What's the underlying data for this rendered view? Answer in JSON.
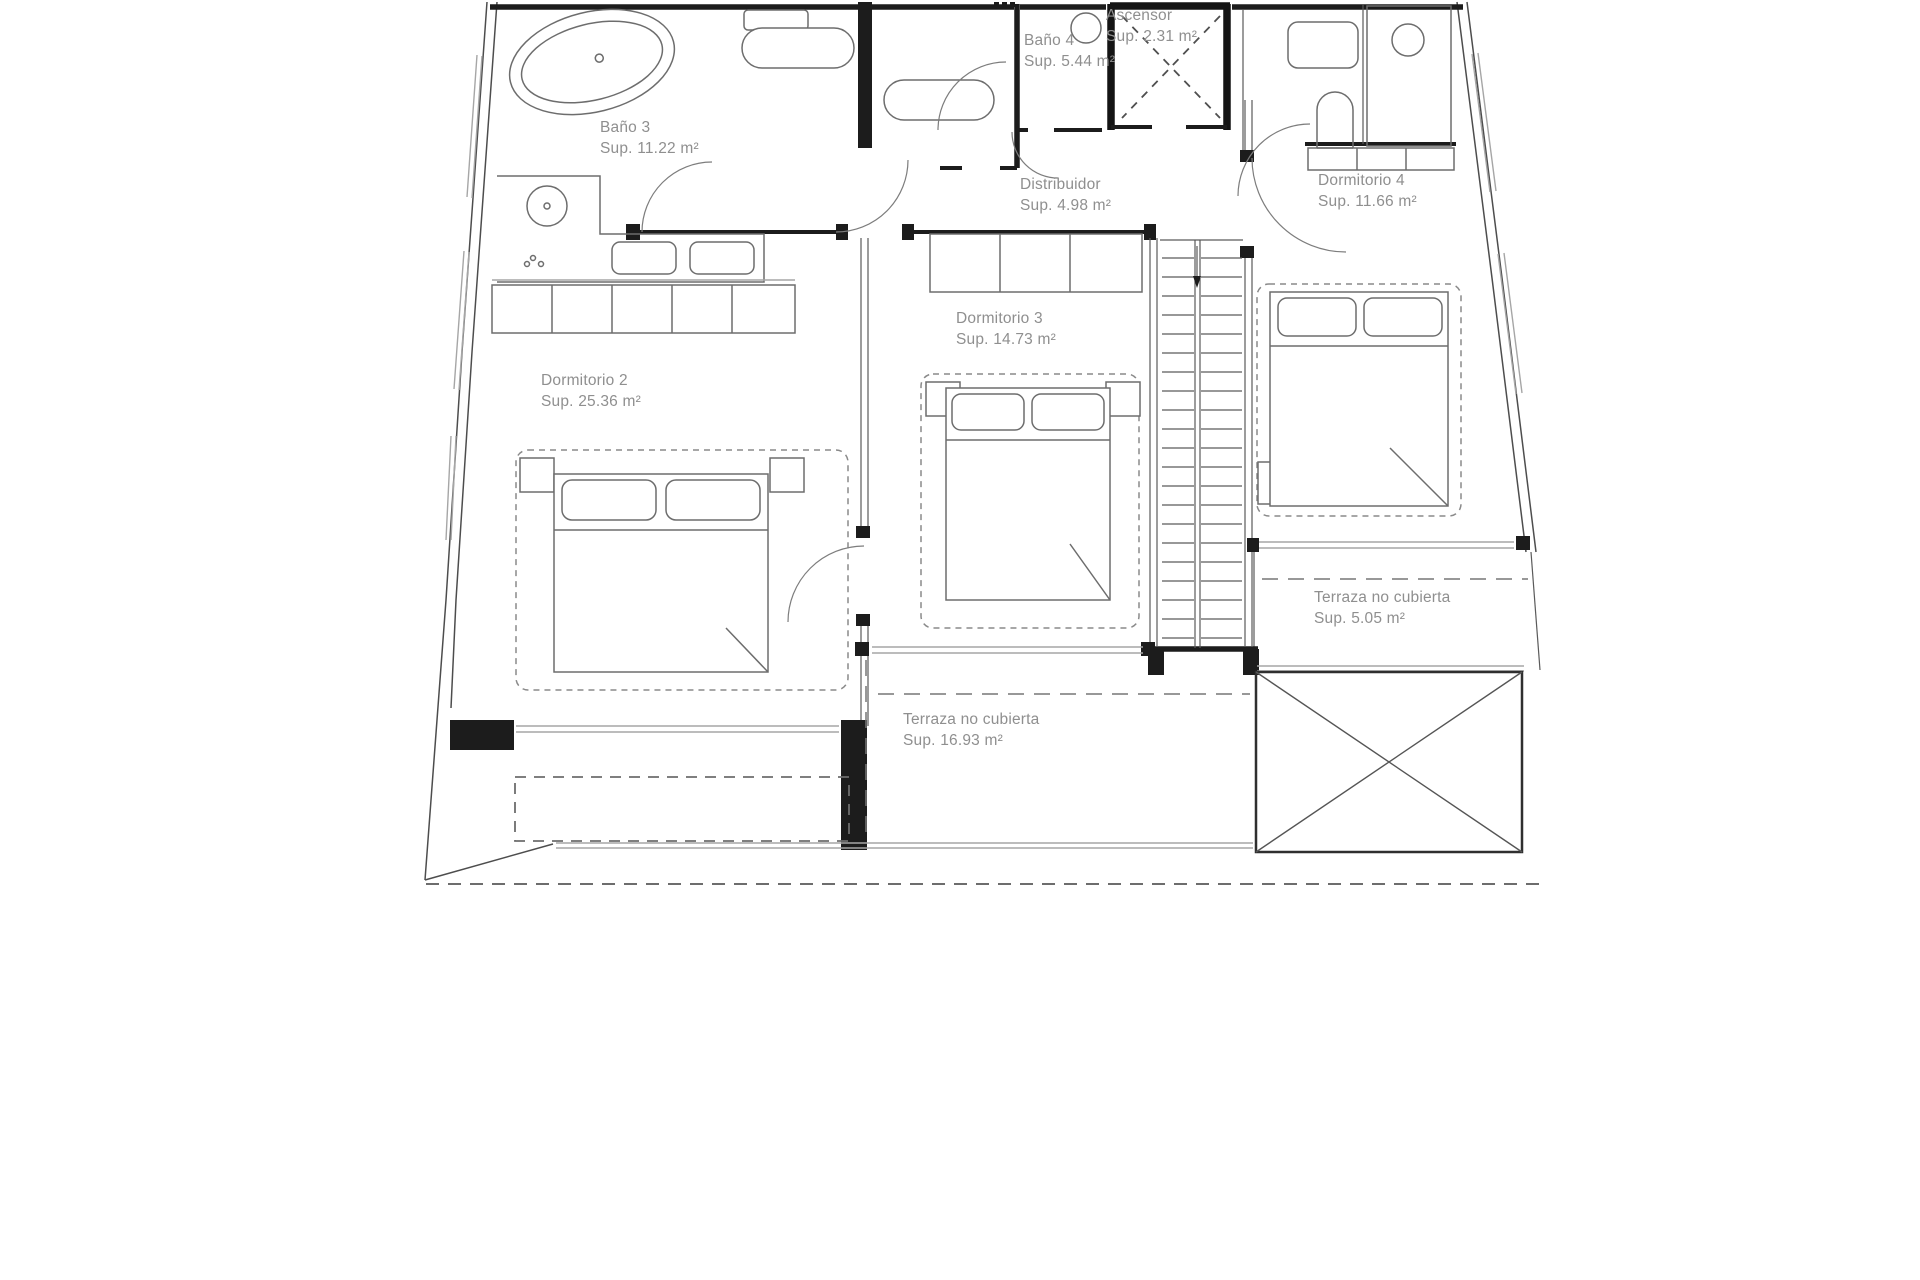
{
  "page": {
    "background": "#ffffff",
    "line_color": "#4d4d4d",
    "label_color": "#8f8f8f"
  },
  "plan": {
    "type": "architectural-floor-plan",
    "language": "Spanish",
    "rooms": [
      {
        "id": "bano3",
        "name": "Baño 3",
        "area": "Sup. 11.22 m²",
        "x": 600,
        "y": 117
      },
      {
        "id": "bano4",
        "name": "Baño 4",
        "area": "Sup. 5.44 m²",
        "x": 1024,
        "y": 30
      },
      {
        "id": "ascensor",
        "name": "Ascensor",
        "area": "Sup. 2.31 m²",
        "x": 1106,
        "y": 5
      },
      {
        "id": "distribuidor",
        "name": "Distribuidor",
        "area": "Sup. 4.98 m²",
        "x": 1020,
        "y": 174
      },
      {
        "id": "dormitorio4",
        "name": "Dormitorio 4",
        "area": "Sup. 11.66 m²",
        "x": 1318,
        "y": 170
      },
      {
        "id": "dormitorio3",
        "name": "Dormitorio 3",
        "area": "Sup. 14.73 m²",
        "x": 956,
        "y": 308
      },
      {
        "id": "dormitorio2",
        "name": "Dormitorio 2",
        "area": "Sup. 25.36 m²",
        "x": 541,
        "y": 370
      },
      {
        "id": "terraza5",
        "name": "Terraza no cubierta",
        "area": "Sup. 5.05 m²",
        "x": 1314,
        "y": 587
      },
      {
        "id": "terraza16",
        "name": "Terraza no cubierta",
        "area": "Sup. 16.93 m²",
        "x": 903,
        "y": 709
      }
    ]
  }
}
